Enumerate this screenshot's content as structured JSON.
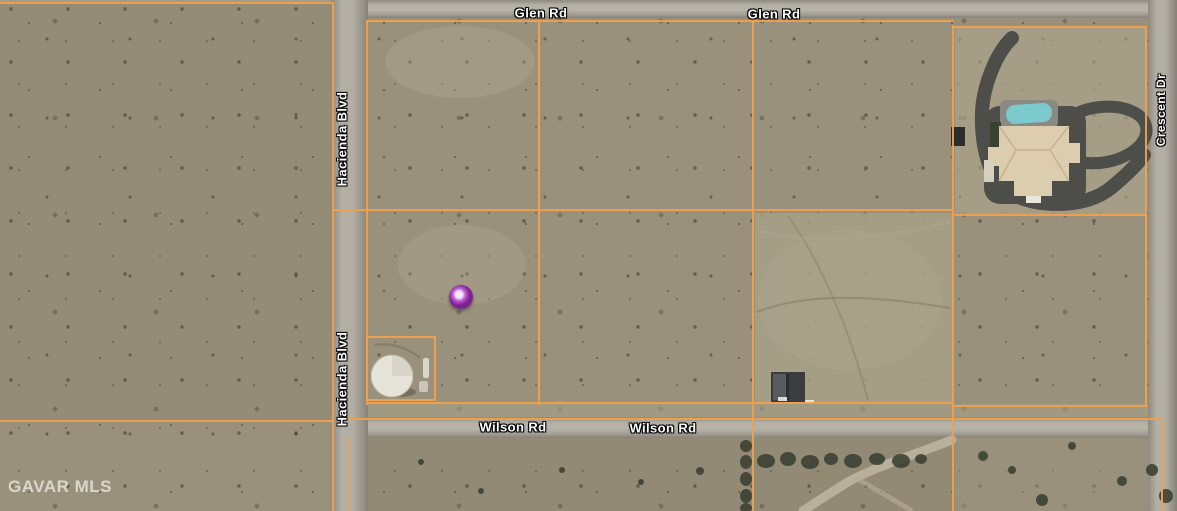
{
  "map": {
    "watermark": "GAVAR MLS",
    "roads": {
      "glen": {
        "label": "Glen Rd"
      },
      "wilson": {
        "label": "Wilson Rd"
      },
      "hacienda": {
        "label": "Hacienda Blvd"
      },
      "crescent": {
        "label": "Crescent Dr"
      }
    },
    "marker": {
      "name": "property-location-marker",
      "color": "#9b2fae"
    },
    "colors": {
      "parcel_line": "#efa04d",
      "terrain": "#9a917c",
      "road": "#aca89e",
      "pool": "#7cc9ce",
      "driveway": "#4d4d49"
    }
  }
}
